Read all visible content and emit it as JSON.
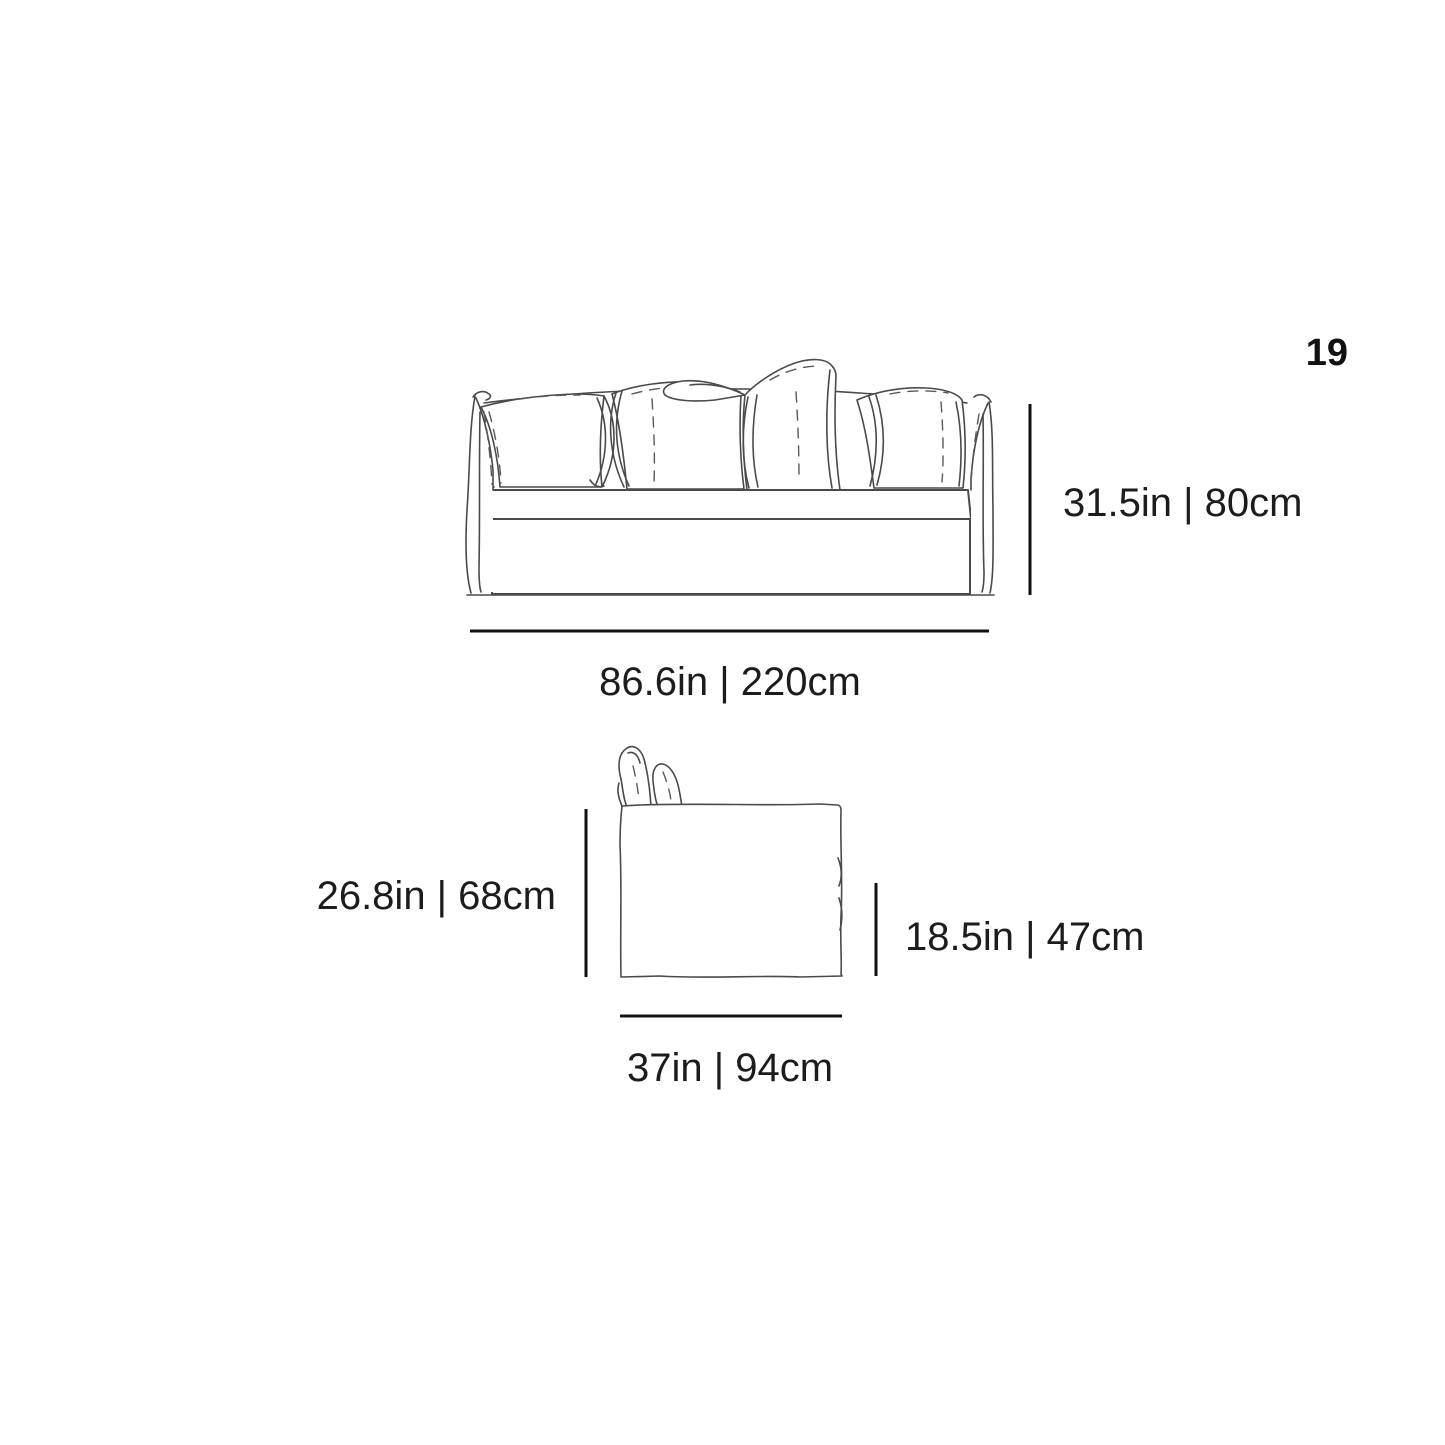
{
  "page": {
    "number": "19",
    "background_color": "#ffffff",
    "sketch_line_color": "#4a4a4a",
    "dimension_line_color": "#111111",
    "text_color": "#1c1c1c"
  },
  "front_view": {
    "height_label": "31.5in | 80cm",
    "width_label": "86.6in | 220cm"
  },
  "side_view": {
    "height_label": "26.8in | 68cm",
    "seat_height_label": "18.5in | 47cm",
    "depth_label": "37in | 94cm"
  }
}
